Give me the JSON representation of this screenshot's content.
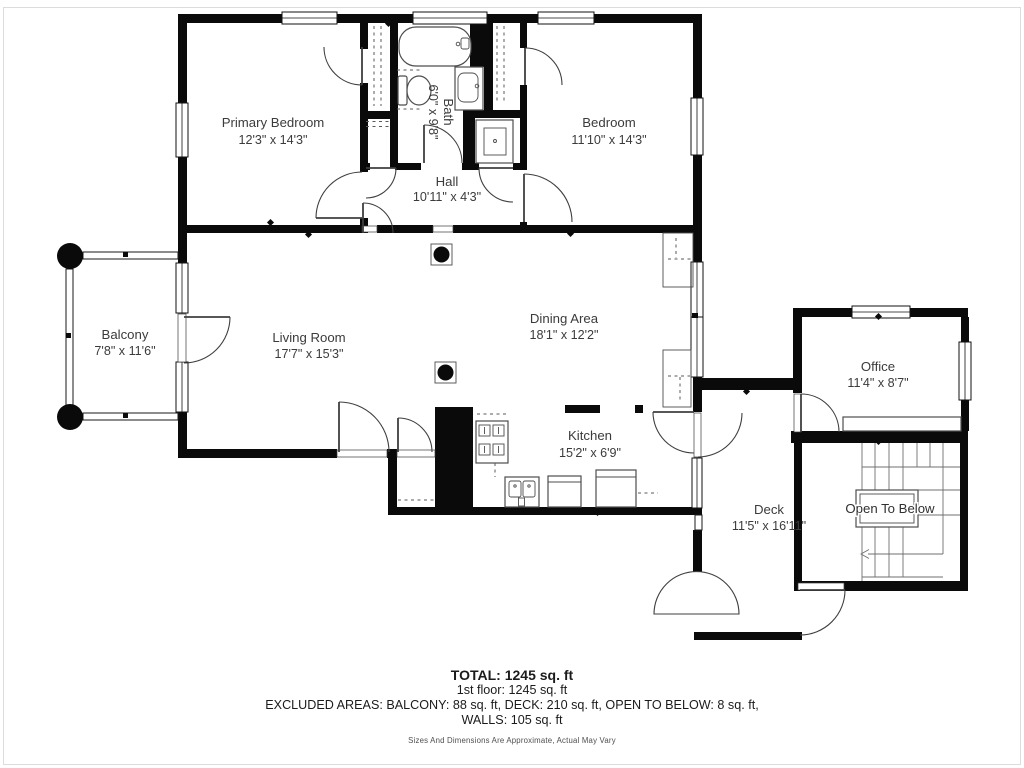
{
  "rooms": {
    "primary_bedroom": {
      "name": "Primary Bedroom",
      "dims": "12'3\" x 14'3\""
    },
    "bedroom": {
      "name": "Bedroom",
      "dims": "11'10\" x 14'3\""
    },
    "bath": {
      "name": "Bath",
      "dims": "6'0\" x 9'8\""
    },
    "hall": {
      "name": "Hall",
      "dims": "10'11\" x 4'3\""
    },
    "balcony": {
      "name": "Balcony",
      "dims": "7'8\" x 11'6\""
    },
    "living_room": {
      "name": "Living Room",
      "dims": "17'7\" x 15'3\""
    },
    "dining_area": {
      "name": "Dining Area",
      "dims": "18'1\" x 12'2\""
    },
    "kitchen": {
      "name": "Kitchen",
      "dims": "15'2\" x 6'9\""
    },
    "office": {
      "name": "Office",
      "dims": "11'4\" x 8'7\""
    },
    "deck": {
      "name": "Deck",
      "dims": "11'5\" x 16'11\""
    },
    "open_to_below": {
      "name": "Open To Below"
    }
  },
  "summary": {
    "total": "TOTAL: 1245 sq. ft",
    "floor_1": "1st floor: 1245 sq. ft",
    "excluded": "EXCLUDED AREAS: BALCONY: 88 sq. ft, DECK: 210 sq. ft, OPEN TO BELOW: 8 sq. ft,",
    "walls": "WALLS: 105 sq. ft",
    "disclaimer": "Sizes And Dimensions Are Approximate, Actual May Vary"
  },
  "icons": {
    "bathtub": "tub outline with faucet",
    "toilet": "tank + bowl outline",
    "sink_vanity": "vanity with basin",
    "shower": "square stall with pan",
    "stove": "4-burner cooktop",
    "kitchen_sink": "double basin sink",
    "dishwasher": "counter appliance",
    "refrigerator": "counter appliance",
    "stairs": "switchback stair treads with down arrow",
    "balcony_post": "round column",
    "support_column": "round column on square base"
  },
  "colors": {
    "wall": "#0a0a0a",
    "label_text": "#3b3b3b",
    "summary_text": "#1b1b1b",
    "background": "#ffffff"
  }
}
